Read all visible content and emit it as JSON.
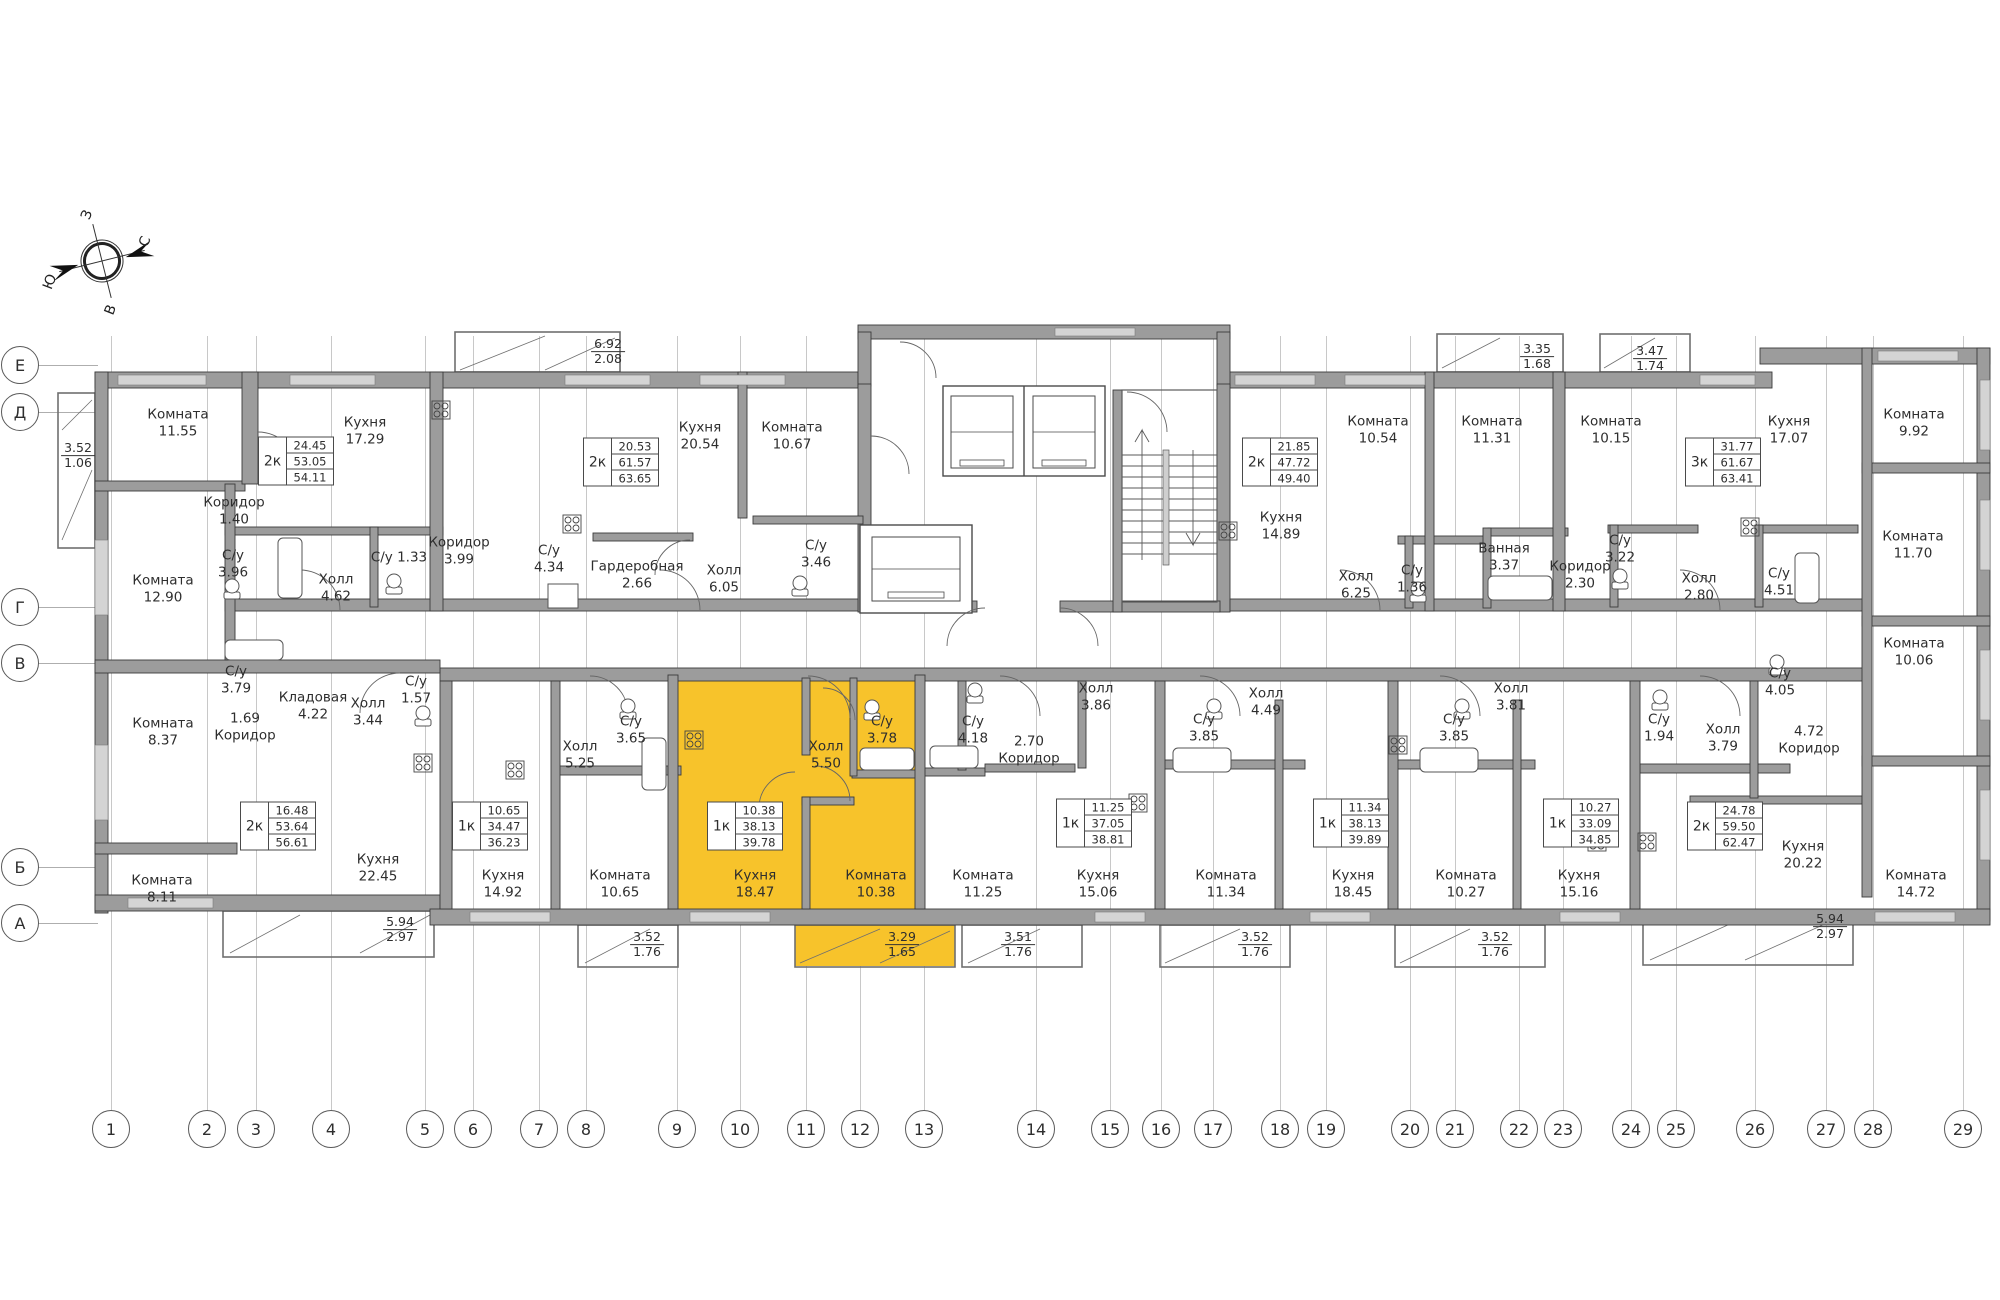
{
  "colors": {
    "highlight": "#F7C32B",
    "wall_fill": "#9c9c9c",
    "wall_line": "#3a3a3a"
  },
  "compass": {
    "top": "З",
    "right": "С",
    "left": "Ю",
    "bottom": "В"
  },
  "axes": {
    "letters": [
      {
        "label": "Е",
        "y": 365
      },
      {
        "label": "Д",
        "y": 412
      },
      {
        "label": "Г",
        "y": 607
      },
      {
        "label": "В",
        "y": 663
      },
      {
        "label": "Б",
        "y": 867
      },
      {
        "label": "А",
        "y": 923
      }
    ],
    "numbers": [
      {
        "label": "1",
        "x": 111
      },
      {
        "label": "2",
        "x": 207
      },
      {
        "label": "3",
        "x": 256
      },
      {
        "label": "4",
        "x": 331
      },
      {
        "label": "5",
        "x": 425
      },
      {
        "label": "6",
        "x": 473
      },
      {
        "label": "7",
        "x": 539
      },
      {
        "label": "8",
        "x": 586
      },
      {
        "label": "9",
        "x": 677
      },
      {
        "label": "10",
        "x": 740
      },
      {
        "label": "11",
        "x": 806
      },
      {
        "label": "12",
        "x": 860
      },
      {
        "label": "13",
        "x": 924
      },
      {
        "label": "14",
        "x": 1036
      },
      {
        "label": "15",
        "x": 1110
      },
      {
        "label": "16",
        "x": 1161
      },
      {
        "label": "17",
        "x": 1213
      },
      {
        "label": "18",
        "x": 1280
      },
      {
        "label": "19",
        "x": 1326
      },
      {
        "label": "20",
        "x": 1410
      },
      {
        "label": "21",
        "x": 1455
      },
      {
        "label": "22",
        "x": 1519
      },
      {
        "label": "23",
        "x": 1563
      },
      {
        "label": "24",
        "x": 1631
      },
      {
        "label": "25",
        "x": 1676
      },
      {
        "label": "26",
        "x": 1755
      },
      {
        "label": "27",
        "x": 1826
      },
      {
        "label": "28",
        "x": 1873
      },
      {
        "label": "29",
        "x": 1963
      }
    ]
  },
  "rooms": [
    {
      "name": "Комната",
      "area": "11.55",
      "x": 178,
      "y": 424
    },
    {
      "name": "Кухня",
      "area": "17.29",
      "x": 365,
      "y": 432
    },
    {
      "name": "Коридор",
      "area": "1.40",
      "x": 234,
      "y": 512
    },
    {
      "name": "С/у",
      "area": "3.96",
      "x": 233,
      "y": 565
    },
    {
      "name": "Комната",
      "area": "12.90",
      "x": 163,
      "y": 590
    },
    {
      "name": "Холл",
      "area": "4.62",
      "x": 336,
      "y": 589
    },
    {
      "name": "С/у 1.33",
      "area": "",
      "x": 399,
      "y": 558
    },
    {
      "name": "Коридор",
      "area": "3.99",
      "x": 459,
      "y": 552
    },
    {
      "name": "С/у",
      "area": "4.34",
      "x": 549,
      "y": 560
    },
    {
      "name": "Кухня",
      "area": "20.54",
      "x": 700,
      "y": 437
    },
    {
      "name": "Комната",
      "area": "10.67",
      "x": 792,
      "y": 437
    },
    {
      "name": "Гардеробная",
      "area": "2.66",
      "x": 637,
      "y": 576
    },
    {
      "name": "Холл",
      "area": "6.05",
      "x": 724,
      "y": 580
    },
    {
      "name": "С/у",
      "area": "3.46",
      "x": 816,
      "y": 555
    },
    {
      "name": "Кухня",
      "area": "14.89",
      "x": 1281,
      "y": 527
    },
    {
      "name": "Комната",
      "area": "10.54",
      "x": 1378,
      "y": 431
    },
    {
      "name": "Комната",
      "area": "11.31",
      "x": 1492,
      "y": 431
    },
    {
      "name": "Ванная",
      "area": "3.37",
      "x": 1504,
      "y": 558
    },
    {
      "name": "С/у",
      "area": "1.36",
      "x": 1412,
      "y": 580
    },
    {
      "name": "Холл",
      "area": "6.25",
      "x": 1356,
      "y": 586
    },
    {
      "name": "Коридор",
      "area": "2.30",
      "x": 1580,
      "y": 576
    },
    {
      "name": "Комната",
      "area": "10.15",
      "x": 1611,
      "y": 431
    },
    {
      "name": "Кухня",
      "area": "17.07",
      "x": 1789,
      "y": 431
    },
    {
      "name": "Холл",
      "area": "2.80",
      "x": 1699,
      "y": 588
    },
    {
      "name": "С/у",
      "area": "3.22",
      "x": 1620,
      "y": 550
    },
    {
      "name": "С/у",
      "area": "4.51",
      "x": 1779,
      "y": 583
    },
    {
      "name": "Комната",
      "area": "9.92",
      "x": 1914,
      "y": 424
    },
    {
      "name": "Комната",
      "area": "11.70",
      "x": 1913,
      "y": 546
    },
    {
      "name": "Комната",
      "area": "10.06",
      "x": 1914,
      "y": 653
    },
    {
      "name": "Комната",
      "area": "8.37",
      "x": 163,
      "y": 733
    },
    {
      "name": "С/у",
      "area": "3.79",
      "x": 236,
      "y": 681
    },
    {
      "name": "Кладовая",
      "area": "4.22",
      "x": 313,
      "y": 707
    },
    {
      "name": "Холл",
      "area": "3.44",
      "x": 368,
      "y": 713
    },
    {
      "name": "С/у",
      "area": "1.57",
      "x": 416,
      "y": 691
    },
    {
      "name": "Коридор",
      "area": "1.69",
      "vf": true,
      "x": 245,
      "y": 728
    },
    {
      "name": "Комната",
      "area": "8.11",
      "x": 162,
      "y": 890
    },
    {
      "name": "Кухня",
      "area": "22.45",
      "x": 378,
      "y": 869
    },
    {
      "name": "Кухня",
      "area": "14.92",
      "x": 503,
      "y": 885
    },
    {
      "name": "Холл",
      "area": "5.25",
      "x": 580,
      "y": 756
    },
    {
      "name": "С/у",
      "area": "3.65",
      "x": 631,
      "y": 731
    },
    {
      "name": "Комната",
      "area": "10.65",
      "x": 620,
      "y": 885
    },
    {
      "name": "Кухня",
      "area": "18.47",
      "hl": true,
      "x": 755,
      "y": 885
    },
    {
      "name": "Холл",
      "area": "5.50",
      "hl": true,
      "x": 826,
      "y": 756
    },
    {
      "name": "С/у",
      "area": "3.78",
      "hl": true,
      "x": 882,
      "y": 731
    },
    {
      "name": "Комната",
      "area": "10.38",
      "hl": true,
      "x": 876,
      "y": 885
    },
    {
      "name": "С/у",
      "area": "4.18",
      "x": 973,
      "y": 731
    },
    {
      "name": "Коридор",
      "area": "2.70",
      "vf": true,
      "x": 1029,
      "y": 751
    },
    {
      "name": "Комната",
      "area": "11.25",
      "x": 983,
      "y": 885
    },
    {
      "name": "Холл",
      "area": "3.86",
      "x": 1096,
      "y": 698
    },
    {
      "name": "Кухня",
      "area": "15.06",
      "x": 1098,
      "y": 885
    },
    {
      "name": "С/у",
      "area": "3.85",
      "x": 1204,
      "y": 729
    },
    {
      "name": "Комната",
      "area": "11.34",
      "x": 1226,
      "y": 885
    },
    {
      "name": "Холл",
      "area": "4.49",
      "x": 1266,
      "y": 703
    },
    {
      "name": "Кухня",
      "area": "18.45",
      "x": 1353,
      "y": 885
    },
    {
      "name": "С/у",
      "area": "3.85",
      "x": 1454,
      "y": 729
    },
    {
      "name": "Холл",
      "area": "3.81",
      "x": 1511,
      "y": 698
    },
    {
      "name": "Комната",
      "area": "10.27",
      "x": 1466,
      "y": 885
    },
    {
      "name": "Кухня",
      "area": "15.16",
      "x": 1579,
      "y": 885
    },
    {
      "name": "С/у",
      "area": "1.94",
      "x": 1659,
      "y": 729
    },
    {
      "name": "Холл",
      "area": "3.79",
      "x": 1723,
      "y": 739
    },
    {
      "name": "С/у",
      "area": "4.05",
      "x": 1780,
      "y": 683
    },
    {
      "name": "Коридор",
      "area": "4.72",
      "vf": true,
      "x": 1809,
      "y": 741
    },
    {
      "name": "Кухня",
      "area": "20.22",
      "x": 1803,
      "y": 856
    },
    {
      "name": "Комната",
      "area": "14.72",
      "x": 1916,
      "y": 885
    }
  ],
  "specs": [
    {
      "type": "2к",
      "values": [
        "24.45",
        "53.05",
        "54.11"
      ],
      "x": 296,
      "y": 461
    },
    {
      "type": "2к",
      "values": [
        "20.53",
        "61.57",
        "63.65"
      ],
      "x": 621,
      "y": 462
    },
    {
      "type": "2к",
      "values": [
        "21.85",
        "47.72",
        "49.40"
      ],
      "x": 1280,
      "y": 462
    },
    {
      "type": "3к",
      "values": [
        "31.77",
        "61.67",
        "63.41"
      ],
      "x": 1723,
      "y": 462
    },
    {
      "type": "2к",
      "values": [
        "16.48",
        "53.64",
        "56.61"
      ],
      "x": 278,
      "y": 826
    },
    {
      "type": "1к",
      "values": [
        "10.65",
        "34.47",
        "36.23"
      ],
      "x": 490,
      "y": 826
    },
    {
      "type": "1к",
      "values": [
        "10.38",
        "38.13",
        "39.78"
      ],
      "x": 745,
      "y": 826
    },
    {
      "type": "1к",
      "values": [
        "11.25",
        "37.05",
        "38.81"
      ],
      "x": 1094,
      "y": 823
    },
    {
      "type": "1к",
      "values": [
        "11.34",
        "38.13",
        "39.89"
      ],
      "x": 1351,
      "y": 823
    },
    {
      "type": "1к",
      "values": [
        "10.27",
        "33.09",
        "34.85"
      ],
      "x": 1581,
      "y": 823
    },
    {
      "type": "2к",
      "values": [
        "24.78",
        "59.50",
        "62.47"
      ],
      "x": 1725,
      "y": 826
    }
  ],
  "balconies": [
    {
      "top": "3.52",
      "bottom": "1.06",
      "x": 78,
      "y": 456
    },
    {
      "top": "6.92",
      "bottom": "2.08",
      "x": 608,
      "y": 352
    },
    {
      "top": "3.35",
      "bottom": "1.68",
      "x": 1537,
      "y": 357
    },
    {
      "top": "3.47",
      "bottom": "1.74",
      "x": 1650,
      "y": 359
    },
    {
      "top": "5.94",
      "bottom": "2.97",
      "x": 400,
      "y": 930
    },
    {
      "top": "3.52",
      "bottom": "1.76",
      "x": 647,
      "y": 945
    },
    {
      "top": "3.29",
      "bottom": "1.65",
      "x": 902,
      "y": 945
    },
    {
      "top": "3.51",
      "bottom": "1.76",
      "x": 1018,
      "y": 945
    },
    {
      "top": "3.52",
      "bottom": "1.76",
      "x": 1255,
      "y": 945
    },
    {
      "top": "3.52",
      "bottom": "1.76",
      "x": 1495,
      "y": 945
    },
    {
      "top": "5.94",
      "bottom": "2.97",
      "x": 1830,
      "y": 927
    }
  ]
}
